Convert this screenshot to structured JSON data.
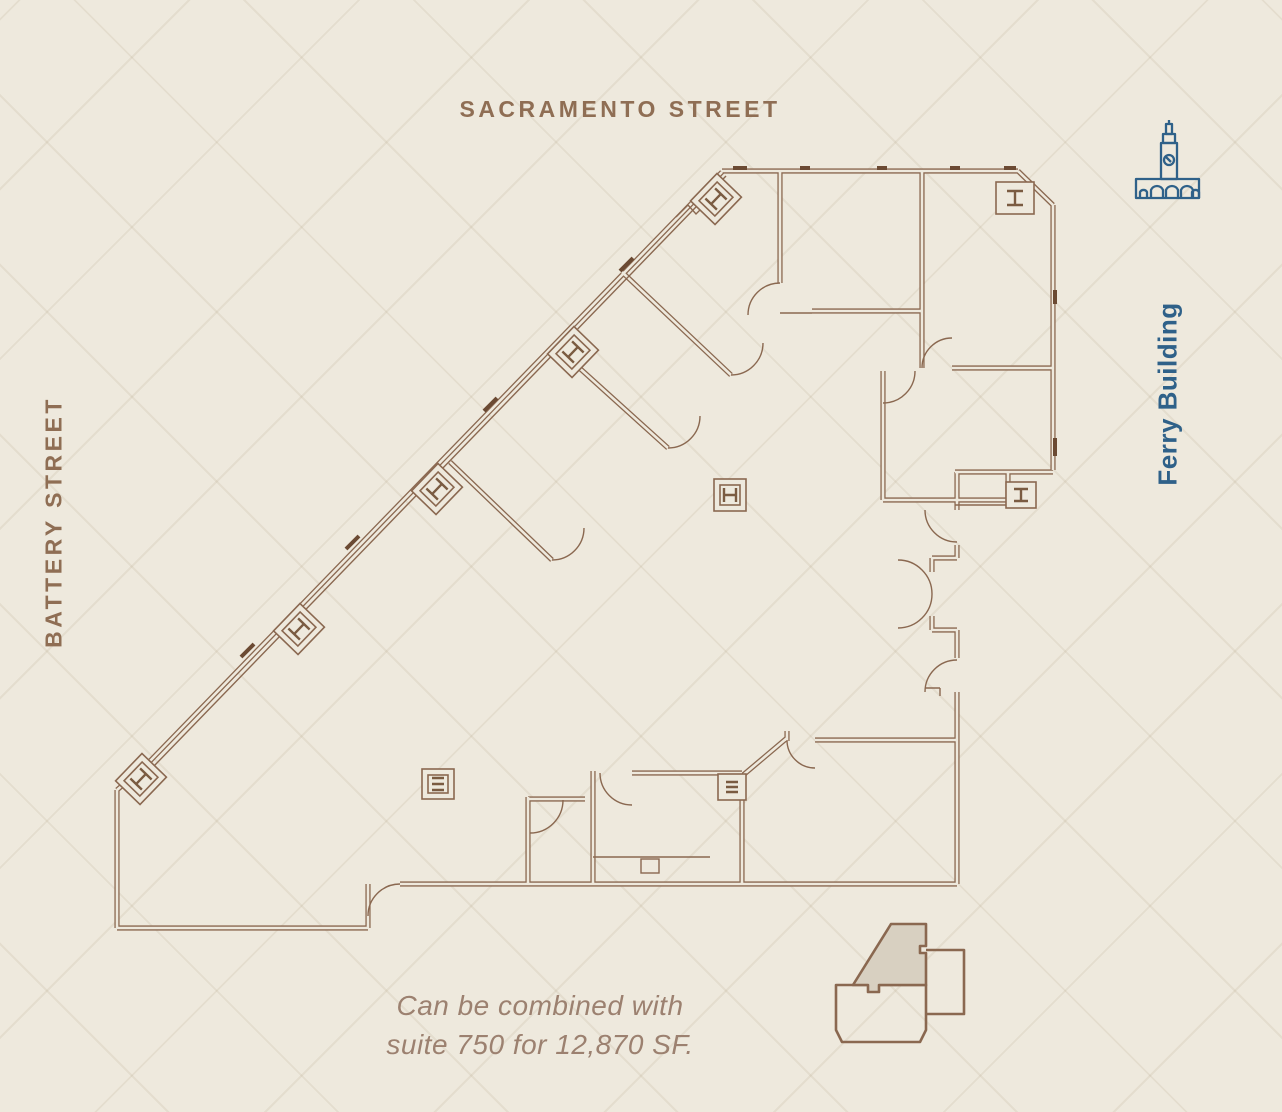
{
  "page": {
    "background_color": "#eee9dd",
    "pattern": "subtle-herringbone",
    "pattern_line_color": "#e3dccb"
  },
  "street_labels": {
    "top": "SACRAMENTO STREET",
    "left": "BATTERY STREET",
    "color": "#8f6e54"
  },
  "landmark": {
    "label": "Ferry Building",
    "icon": "ferry-building-clock-tower-icon",
    "color": "#2f6189"
  },
  "floor_plan": {
    "description": "suite-floor-plan-outline",
    "line_color": "#8a6850",
    "dark_accent_color": "#6b4a33"
  },
  "note": {
    "line1": "Can be combined with",
    "line2": "suite 750 for 12,870 SF.",
    "color": "#9c8170"
  },
  "key_plan": {
    "description": "building-footprint-minimap-with-suite-highlighted",
    "suite_fill_color": "#d8d0c1",
    "outline_color": "#8a6850"
  }
}
